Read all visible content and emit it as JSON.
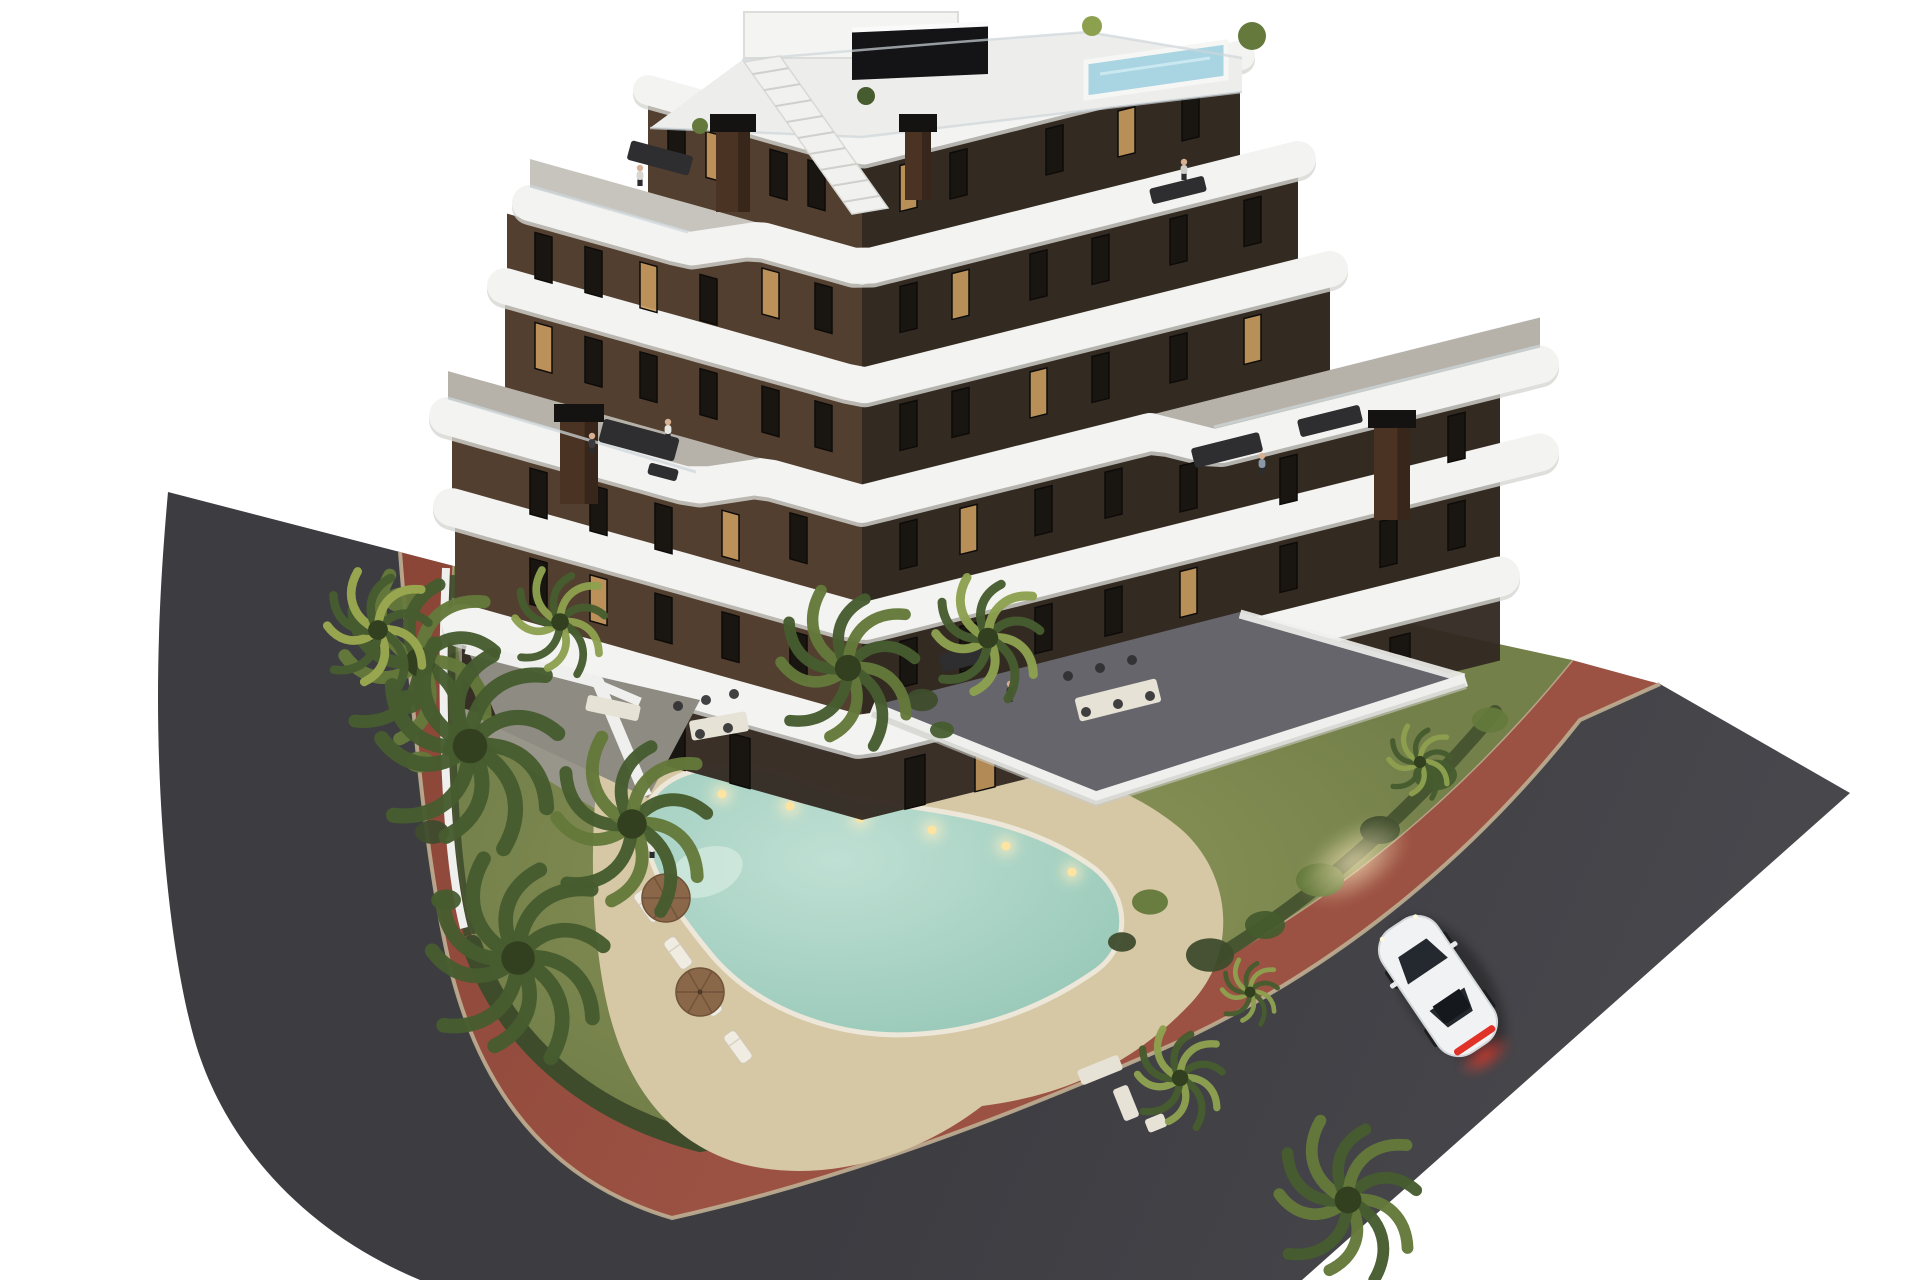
{
  "scene": {
    "title": "Aerial dusk 3D architectural rendering of a modern apartment building with curved white balconies, garden pool, palm trees, red bike path and a white car on the road",
    "time_of_day": "dusk",
    "text_content": "none"
  },
  "colors": {
    "background": "#ffffff",
    "asphalt": "#3c3c41",
    "asphalt_light": "#47474c",
    "red_path": "#9c5243",
    "red_path_dark": "#8a4537",
    "curb": "#bfae92",
    "hedge": "#3e4c2c",
    "lawn": "#74804a",
    "lawn_light": "#8d975a",
    "sand": "#d7c8a5",
    "gravel": "#8b8679",
    "pool_water": "#bfe0d4",
    "pool_deep": "#8fc3b2",
    "pool_light": "#ffe3a1",
    "roof_pool": "#a9d4e2",
    "facade_left": "#523f2f",
    "facade_right": "#332a22",
    "band_white": "#f3f3f1",
    "band_shade": "#d6d6d2",
    "deck": "#b6b2a9",
    "deck_sun": "#c7c4bd",
    "paving": "#65656b",
    "terrace_gray": "#8e8b83",
    "concrete": "#9a968d",
    "wall_white": "#efefed",
    "window_glass": "#191511",
    "window_glow": "#c89a5e",
    "window_frame": "#0d0b09",
    "chimney": "#4a3322",
    "chimney_cap": "#141311",
    "palm_dark": "#465c2e",
    "palm_mid": "#64793b",
    "palm_light": "#8da04e",
    "palm_yellow": "#9aa84f",
    "trunk": "#6e5c45",
    "car_body": "#f1f2f4",
    "car_glass": "#23292f",
    "taillight": "#e03227",
    "umbrella": "#8a6748",
    "furniture_dark": "#2e2e30",
    "furniture_light": "#e6e2d6",
    "roof_deck": "#ededeb",
    "glass_rail": "#cdd6da",
    "skin": "#d8b094"
  },
  "building": {
    "floors_visible": 7,
    "wings": 2,
    "slopes": {
      "vx": 862,
      "sL": 0.28,
      "sR": 0.25
    },
    "bands": [
      {
        "yv": 150,
        "xl": 648,
        "xr": 1240,
        "h": 30
      },
      {
        "yv": 268,
        "xl": 530,
        "xr": 1298,
        "h": 36,
        "jogL": {
          "off": 28,
          "to": 690,
          "trans": 755,
          "deck": "deck_sun"
        }
      },
      {
        "yv": 386,
        "xl": 505,
        "xr": 1330,
        "h": 36
      },
      {
        "yv": 504,
        "xl": 448,
        "xr": 1540,
        "h": 38,
        "jogL": {
          "off": 28,
          "to": 695,
          "trans": 760,
          "deck": "deck"
        },
        "jogR": {
          "off": 30,
          "from": 1215,
          "trans": 1155,
          "deck": "deck"
        }
      },
      {
        "yv": 622,
        "xl": 452,
        "xr": 1540,
        "h": 38
      },
      {
        "yv": 736,
        "xl": 462,
        "xr": 1500,
        "h": 40
      }
    ],
    "facades": [
      {
        "xl": 648,
        "xr": 1240,
        "a": 0,
        "b": 1,
        "winL": [
          668,
          706,
          770,
          808
        ],
        "litL": [
          1
        ],
        "winR": [
          900,
          950,
          1046,
          1118,
          1182
        ],
        "litR": [
          0,
          3
        ]
      },
      {
        "xl": 507,
        "xr": 1298,
        "a": 1,
        "b": 2,
        "winL": [
          535,
          585,
          640,
          700,
          762,
          815
        ],
        "litL": [
          2,
          4
        ],
        "winR": [
          900,
          952,
          1030,
          1092,
          1170,
          1244
        ],
        "litR": [
          1
        ]
      },
      {
        "xl": 505,
        "xr": 1330,
        "a": 2,
        "b": 3,
        "winL": [
          535,
          585,
          640,
          700,
          762,
          815
        ],
        "litL": [
          0
        ],
        "winR": [
          900,
          952,
          1030,
          1092,
          1170,
          1244
        ],
        "litR": [
          2,
          5
        ]
      },
      {
        "xl": 452,
        "xr": 1500,
        "a": 3,
        "b": 4,
        "winL": [
          530,
          590,
          655,
          722,
          790
        ],
        "litL": [
          3
        ],
        "winR": [
          900,
          960,
          1035,
          1105,
          1180,
          1280,
          1380,
          1448
        ],
        "litR": [
          1,
          6
        ]
      },
      {
        "xl": 455,
        "xr": 1500,
        "a": 4,
        "b": 5,
        "winL": [
          530,
          590,
          655,
          722,
          790
        ],
        "litL": [
          1
        ],
        "winR": [
          900,
          960,
          1035,
          1105,
          1180,
          1280,
          1380,
          1448
        ],
        "litR": [
          4
        ]
      }
    ],
    "doors": {
      "band": 5,
      "xs": [
        540,
        600,
        665,
        730,
        905,
        975,
        1050,
        1130,
        1210,
        1300,
        1390
      ],
      "lit": [
        1,
        5,
        8
      ]
    },
    "window": {
      "w": 17,
      "h": 46,
      "skewL": 15.6,
      "skewR": -14
    },
    "door": {
      "w": 20,
      "h": 50
    }
  },
  "palms": [
    {
      "x": 420,
      "y": 662,
      "r": 92,
      "tone": "palm_mid"
    },
    {
      "x": 470,
      "y": 746,
      "r": 108,
      "tone": "palm_dark"
    },
    {
      "x": 632,
      "y": 824,
      "r": 92,
      "tone": "palm_mid"
    },
    {
      "x": 518,
      "y": 958,
      "r": 105,
      "tone": "palm_dark"
    },
    {
      "x": 378,
      "y": 630,
      "r": 62,
      "tone": "palm_yellow"
    },
    {
      "x": 560,
      "y": 622,
      "r": 55,
      "tone": "palm_light"
    },
    {
      "x": 848,
      "y": 668,
      "r": 82,
      "tone": "palm_mid"
    },
    {
      "x": 988,
      "y": 638,
      "r": 64,
      "tone": "palm_light"
    },
    {
      "x": 1180,
      "y": 1078,
      "r": 52,
      "tone": "palm_light"
    },
    {
      "x": 1348,
      "y": 1200,
      "r": 84,
      "tone": "palm_mid"
    },
    {
      "x": 1250,
      "y": 992,
      "r": 34,
      "tone": "palm_light"
    },
    {
      "x": 1420,
      "y": 762,
      "r": 38,
      "tone": "palm_light"
    }
  ],
  "bushes": [
    {
      "x": 1210,
      "y": 955,
      "r": 24
    },
    {
      "x": 1265,
      "y": 925,
      "r": 20
    },
    {
      "x": 1320,
      "y": 880,
      "r": 24
    },
    {
      "x": 1380,
      "y": 830,
      "r": 20
    },
    {
      "x": 1435,
      "y": 775,
      "r": 22
    },
    {
      "x": 1490,
      "y": 720,
      "r": 18
    },
    {
      "x": 922,
      "y": 700,
      "r": 16
    },
    {
      "x": 942,
      "y": 730,
      "r": 12
    },
    {
      "x": 402,
      "y": 600,
      "r": 18
    },
    {
      "x": 414,
      "y": 650,
      "r": 15
    },
    {
      "x": 406,
      "y": 702,
      "r": 17
    },
    {
      "x": 420,
      "y": 762,
      "r": 15
    },
    {
      "x": 432,
      "y": 832,
      "r": 17
    },
    {
      "x": 446,
      "y": 900,
      "r": 15
    },
    {
      "x": 1150,
      "y": 902,
      "r": 18
    },
    {
      "x": 1122,
      "y": 942,
      "r": 14
    }
  ],
  "pool_lights": [
    {
      "x": 722,
      "y": 794
    },
    {
      "x": 790,
      "y": 806
    },
    {
      "x": 860,
      "y": 818
    },
    {
      "x": 932,
      "y": 830
    },
    {
      "x": 1006,
      "y": 846
    },
    {
      "x": 1072,
      "y": 872
    }
  ],
  "loungers": [
    {
      "x": 648,
      "y": 906
    },
    {
      "x": 678,
      "y": 953
    },
    {
      "x": 708,
      "y": 1000
    },
    {
      "x": 738,
      "y": 1047
    }
  ],
  "umbrellas": [
    {
      "x": 666,
      "y": 898
    },
    {
      "x": 700,
      "y": 992
    }
  ],
  "furniture": [
    {
      "x": 628,
      "y": 148,
      "w": 64,
      "h": 20,
      "rot": 15,
      "fill": "furniture_dark"
    },
    {
      "x": 1150,
      "y": 182,
      "w": 56,
      "h": 16,
      "rot": -14,
      "fill": "furniture_dark"
    },
    {
      "x": 600,
      "y": 428,
      "w": 78,
      "h": 24,
      "rot": 15,
      "fill": "furniture_dark"
    },
    {
      "x": 648,
      "y": 466,
      "w": 30,
      "h": 12,
      "rot": 15,
      "fill": "furniture_dark"
    },
    {
      "x": 1192,
      "y": 440,
      "w": 70,
      "h": 20,
      "rot": -14,
      "fill": "furniture_dark"
    },
    {
      "x": 1298,
      "y": 412,
      "w": 64,
      "h": 18,
      "rot": -14,
      "fill": "furniture_dark"
    },
    {
      "x": 1076,
      "y": 688,
      "w": 84,
      "h": 24,
      "rot": -14,
      "fill": "furniture_light"
    },
    {
      "x": 690,
      "y": 716,
      "w": 58,
      "h": 20,
      "rot": -10,
      "fill": "furniture_light"
    },
    {
      "x": 940,
      "y": 648,
      "w": 56,
      "h": 18,
      "rot": -14,
      "fill": "furniture_dark"
    },
    {
      "x": 586,
      "y": 700,
      "w": 54,
      "h": 16,
      "rot": 12,
      "fill": "furniture_light"
    },
    {
      "x": 1078,
      "y": 1062,
      "w": 44,
      "h": 16,
      "rot": -22,
      "fill": "furniture_light"
    },
    {
      "x": 1118,
      "y": 1086,
      "w": 16,
      "h": 34,
      "rot": -22,
      "fill": "furniture_light"
    },
    {
      "x": 1146,
      "y": 1116,
      "w": 20,
      "h": 14,
      "rot": -22,
      "fill": "furniture_light"
    }
  ],
  "chairs": [
    {
      "x": 1068,
      "y": 676
    },
    {
      "x": 1100,
      "y": 668
    },
    {
      "x": 1132,
      "y": 660
    },
    {
      "x": 1086,
      "y": 712
    },
    {
      "x": 1118,
      "y": 704
    },
    {
      "x": 1150,
      "y": 696
    },
    {
      "x": 678,
      "y": 706
    },
    {
      "x": 706,
      "y": 700
    },
    {
      "x": 734,
      "y": 694
    },
    {
      "x": 700,
      "y": 734
    },
    {
      "x": 728,
      "y": 728
    }
  ],
  "people": [
    {
      "x": 652,
      "y": 850,
      "shirt": "#eceae4"
    },
    {
      "x": 592,
      "y": 446,
      "shirt": "#3a3a3c"
    },
    {
      "x": 668,
      "y": 432,
      "shirt": "#e8e6e0"
    },
    {
      "x": 640,
      "y": 178,
      "shirt": "#d8d6d0"
    },
    {
      "x": 1262,
      "y": 466,
      "shirt": "#8a97a8"
    },
    {
      "x": 1010,
      "y": 694,
      "shirt": "#2e2e30"
    },
    {
      "x": 1184,
      "y": 172,
      "shirt": "#cfcdc8"
    }
  ],
  "chimneys": [
    {
      "x": 716,
      "y": 128,
      "w": 34,
      "h": 84
    },
    {
      "x": 905,
      "y": 128,
      "w": 26,
      "h": 72
    },
    {
      "x": 560,
      "y": 418,
      "w": 38,
      "h": 86
    },
    {
      "x": 1374,
      "y": 424,
      "w": 36,
      "h": 96
    }
  ],
  "car": {
    "x": 1438,
    "y": 986,
    "angle": -34,
    "color": "white",
    "type": "coupe",
    "lights_on": true
  }
}
